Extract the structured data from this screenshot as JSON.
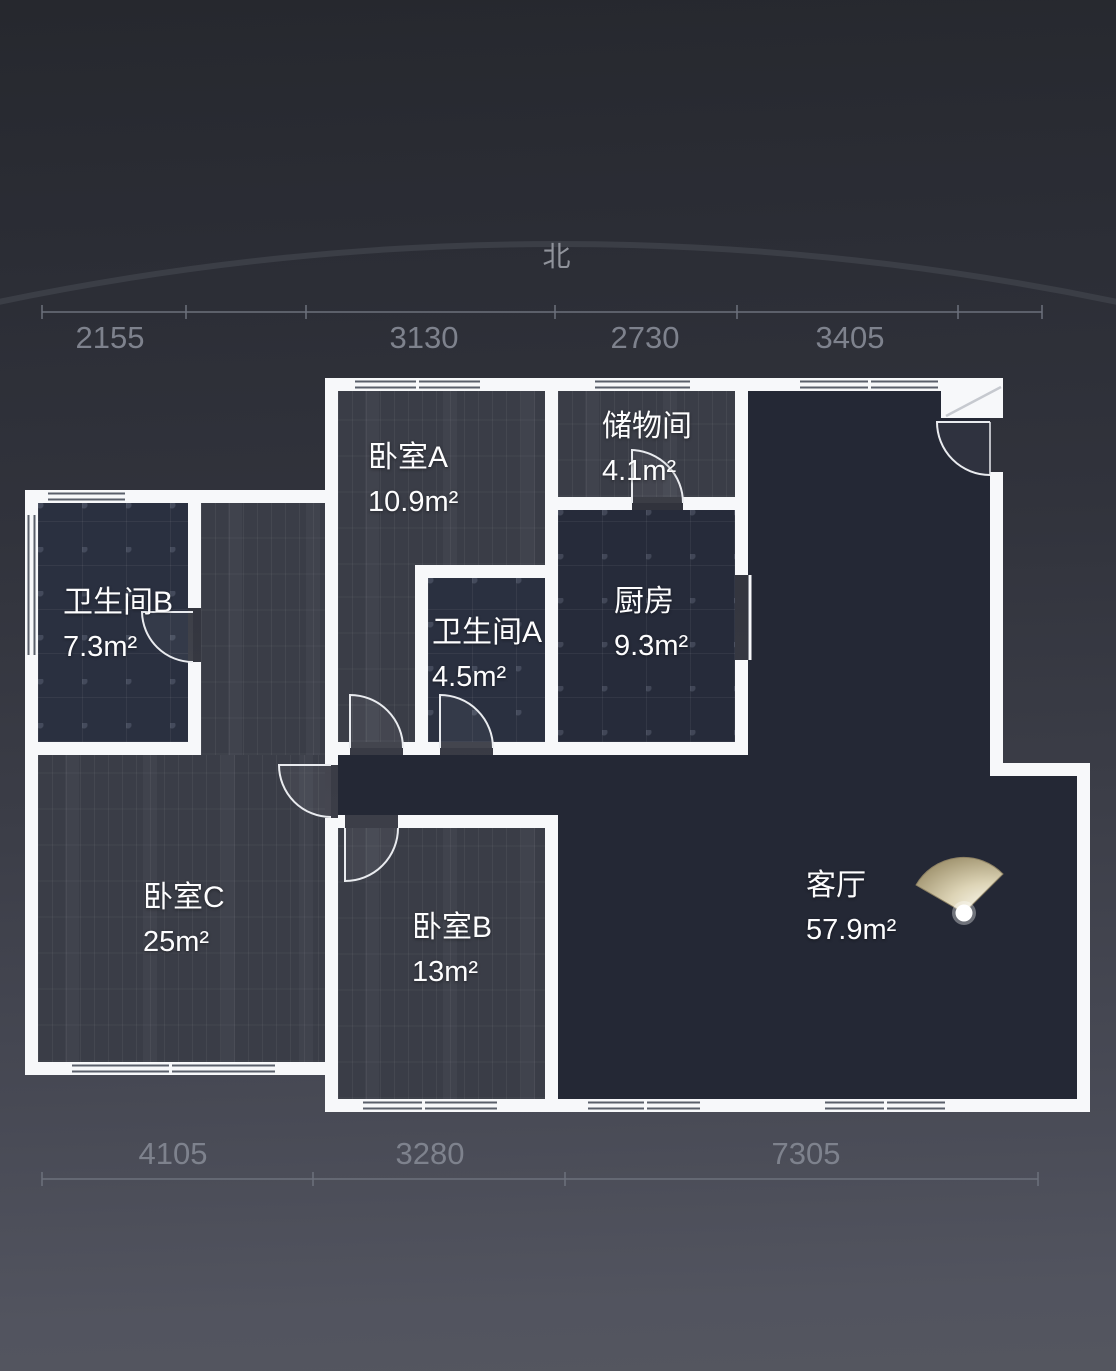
{
  "compass": {
    "north_label": "北"
  },
  "dimensions": {
    "top": [
      {
        "value": "2155"
      },
      {
        "value": "3130"
      },
      {
        "value": "2730"
      },
      {
        "value": "3405"
      }
    ],
    "bottom": [
      {
        "value": "4105"
      },
      {
        "value": "3280"
      },
      {
        "value": "7305"
      }
    ]
  },
  "rooms": [
    {
      "id": "bedroom-a",
      "name": "卧室A",
      "area": "10.9m²"
    },
    {
      "id": "storage",
      "name": "储物间",
      "area": "4.1m²"
    },
    {
      "id": "bathroom-b",
      "name": "卫生间B",
      "area": "7.3m²"
    },
    {
      "id": "bathroom-a",
      "name": "卫生间A",
      "area": "4.5m²"
    },
    {
      "id": "kitchen",
      "name": "厨房",
      "area": "9.3m²"
    },
    {
      "id": "bedroom-c",
      "name": "卧室C",
      "area": "25m²"
    },
    {
      "id": "bedroom-b",
      "name": "卧室B",
      "area": "13m²"
    },
    {
      "id": "living-room",
      "name": "客厅",
      "area": "57.9m²"
    }
  ],
  "colors": {
    "wall": "#f7f8fa",
    "bedroom_floor": "#3a3d47",
    "tile_floor": "#2a3040",
    "kitchen_floor": "#262b3a",
    "living_floor": "#242835",
    "dimension_text": "#7e828d",
    "light_fan": "#ddd4b6"
  }
}
